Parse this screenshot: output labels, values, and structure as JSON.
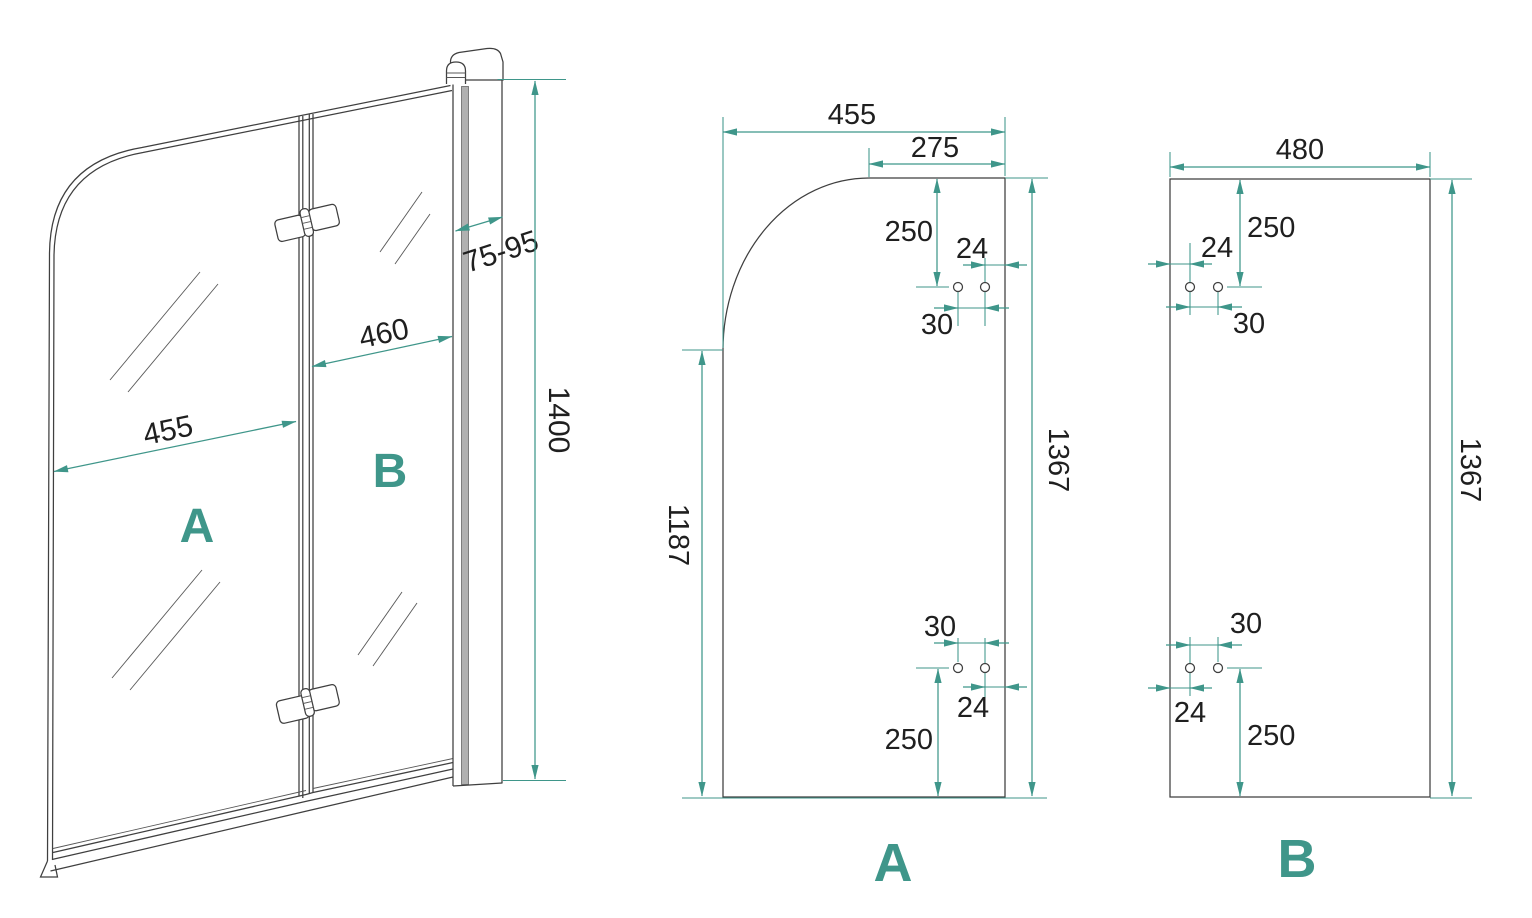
{
  "colors": {
    "accent": "#3f968a",
    "ink": "#1f1f1f",
    "drawing_line": "#3f3f3f"
  },
  "assembled_view": {
    "panel_a_label": "A",
    "panel_b_label": "B",
    "dims": {
      "panel_a_width": "455",
      "panel_b_width": "460",
      "wall_profile_adjust": "75-95",
      "total_height": "1400"
    }
  },
  "panel_a_view": {
    "label": "A",
    "dims": {
      "width": "455",
      "top_flat_width": "275",
      "top_hole_offset": "250",
      "top_hole_edge": "24",
      "top_hole_gap": "30",
      "height_full": "1367",
      "height_straight": "1187",
      "bottom_hole_gap": "30",
      "bottom_hole_edge": "24",
      "bottom_hole_offset": "250"
    }
  },
  "panel_b_view": {
    "label": "B",
    "dims": {
      "width": "480",
      "top_hole_offset": "250",
      "top_hole_edge": "24",
      "top_hole_gap": "30",
      "height_full": "1367",
      "bottom_hole_gap": "30",
      "bottom_hole_edge": "24",
      "bottom_hole_offset": "250"
    }
  }
}
